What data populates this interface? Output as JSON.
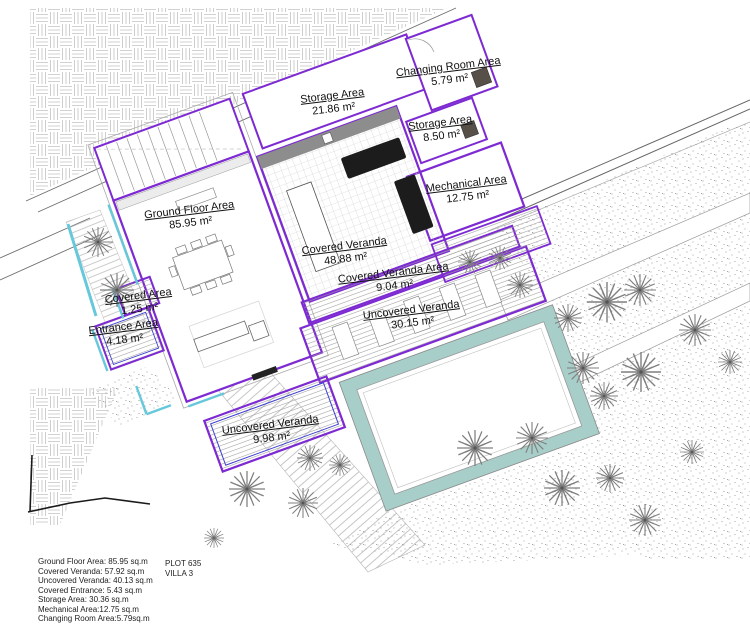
{
  "plan": {
    "rooms": [
      {
        "id": "changing-room",
        "name": "Changing Room Area",
        "area": "5.79 m²",
        "x": 449,
        "y": 61
      },
      {
        "id": "storage-large",
        "name": "Storage Area",
        "area": "21.86 m²",
        "x": 333,
        "y": 90
      },
      {
        "id": "storage-small",
        "name": "Storage Area",
        "area": "8.50 m²",
        "x": 441,
        "y": 117
      },
      {
        "id": "mechanical",
        "name": "Mechanical Area",
        "area": "12.75 m²",
        "x": 467,
        "y": 178
      },
      {
        "id": "ground-floor",
        "name": "Ground Floor Area",
        "area": "85.95 m²",
        "x": 190,
        "y": 204
      },
      {
        "id": "covered-veranda",
        "name": "Covered Veranda",
        "area": "48.88 m²",
        "x": 345,
        "y": 240
      },
      {
        "id": "covered-veranda-area",
        "name": "Covered Veranda Area",
        "area": "9.04 m²",
        "x": 394,
        "y": 267
      },
      {
        "id": "uncovered-veranda",
        "name": "Uncovered Veranda",
        "area": "30.15 m²",
        "x": 412,
        "y": 304
      },
      {
        "id": "covered-area",
        "name": "Covered Area",
        "area": "1.25 m²",
        "x": 139,
        "y": 290
      },
      {
        "id": "entrance-area",
        "name": "Entrance Area",
        "area": "4.18 m²",
        "x": 124,
        "y": 321
      },
      {
        "id": "uncovered-veranda-small",
        "name": "Uncovered Veranda",
        "area": "9.98 m²",
        "x": 271,
        "y": 419
      }
    ]
  },
  "legend": {
    "lines": [
      "Ground Floor Area: 85.95 sq.m",
      "Covered Veranda: 57.92 sq.m",
      "Uncovered Veranda: 40.13 sq.m",
      "Covered Entrance: 5.43 sq.m",
      "Storage Area: 30.36 sq.m",
      "Mechanical Area:12.75 sq.m",
      "Changing Room Area:5.79sq.m"
    ]
  },
  "title_block": {
    "plot": "PLOT 635",
    "villa": "VILLA 3"
  },
  "colors": {
    "outline_purple": "#7D2AD2",
    "accent_blue": "#3E3ED4",
    "accent_cyan": "#66C8DA",
    "pool_teal": "#A8CECA",
    "wall_gray": "#8D8D8D",
    "linework_gray": "#777777"
  }
}
